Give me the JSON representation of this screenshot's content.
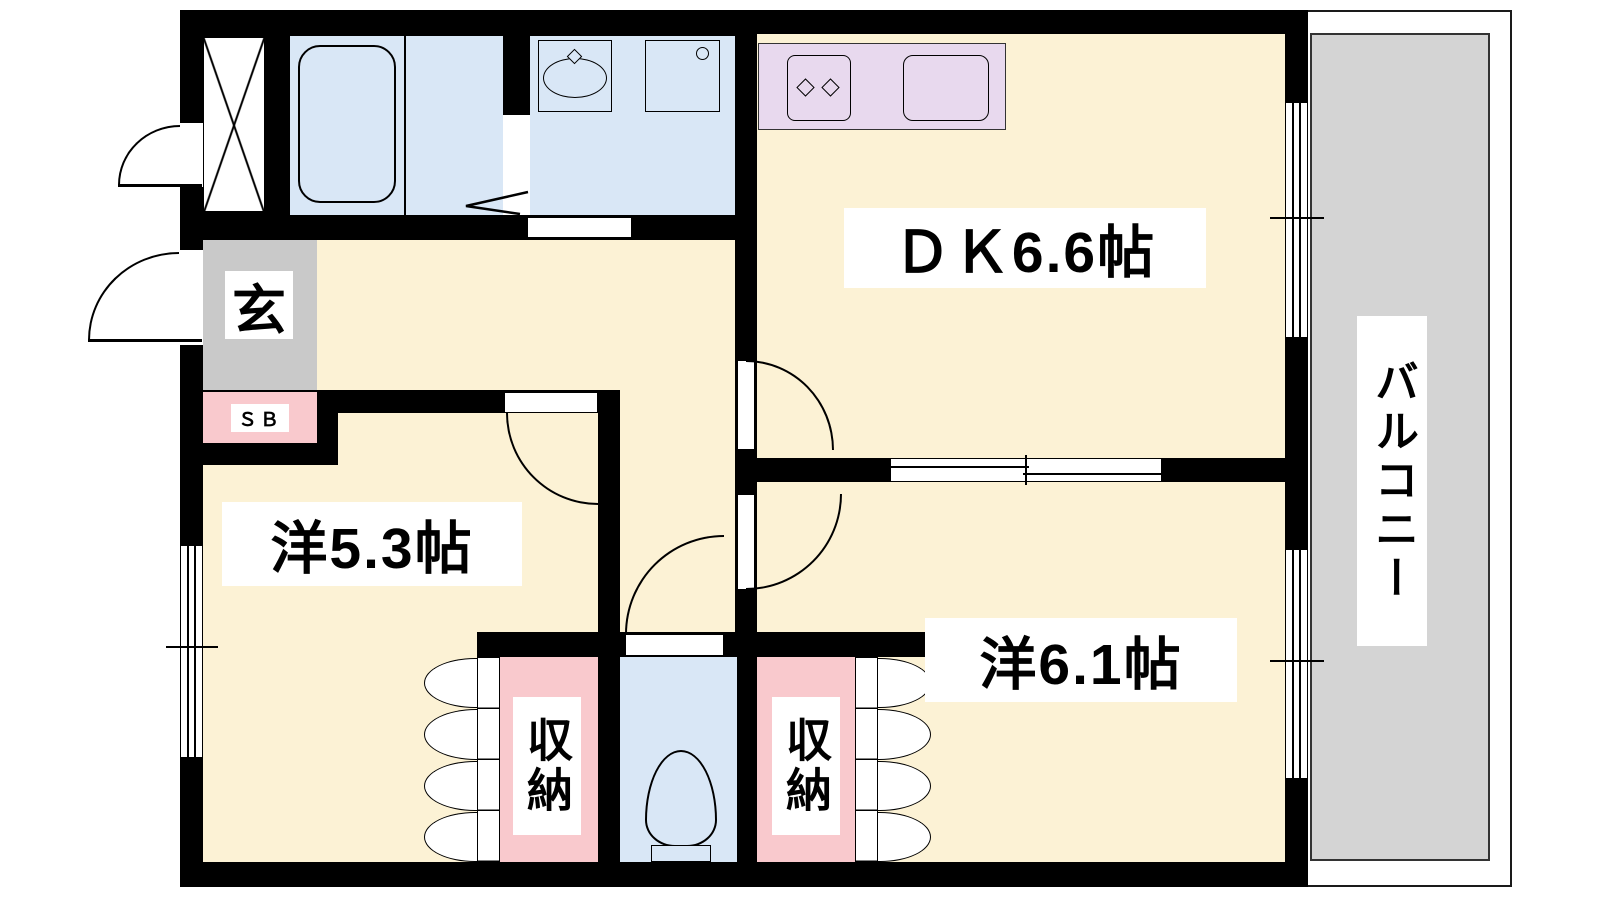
{
  "rooms": {
    "dining_kitchen": {
      "label": "ＤＫ6.6帖"
    },
    "western_room_1": {
      "label": "洋5.3帖"
    },
    "western_room_2": {
      "label": "洋6.1帖"
    },
    "balcony": {
      "label": "バルコニー"
    },
    "entrance": {
      "label": "玄"
    },
    "shoe_box": {
      "label": "ＳＢ"
    },
    "storage_left": {
      "label": "収納"
    },
    "storage_right": {
      "label": "収納"
    }
  },
  "colors": {
    "wall": "#000000",
    "room_floor": "#FCF2D5",
    "wet_area": "#D9E7F6",
    "kitchen_counter": "#E8D9EE",
    "storage": "#F9C9CD",
    "entrance_floor": "#C9C9C9",
    "balcony_floor": "#D4D4D4"
  }
}
